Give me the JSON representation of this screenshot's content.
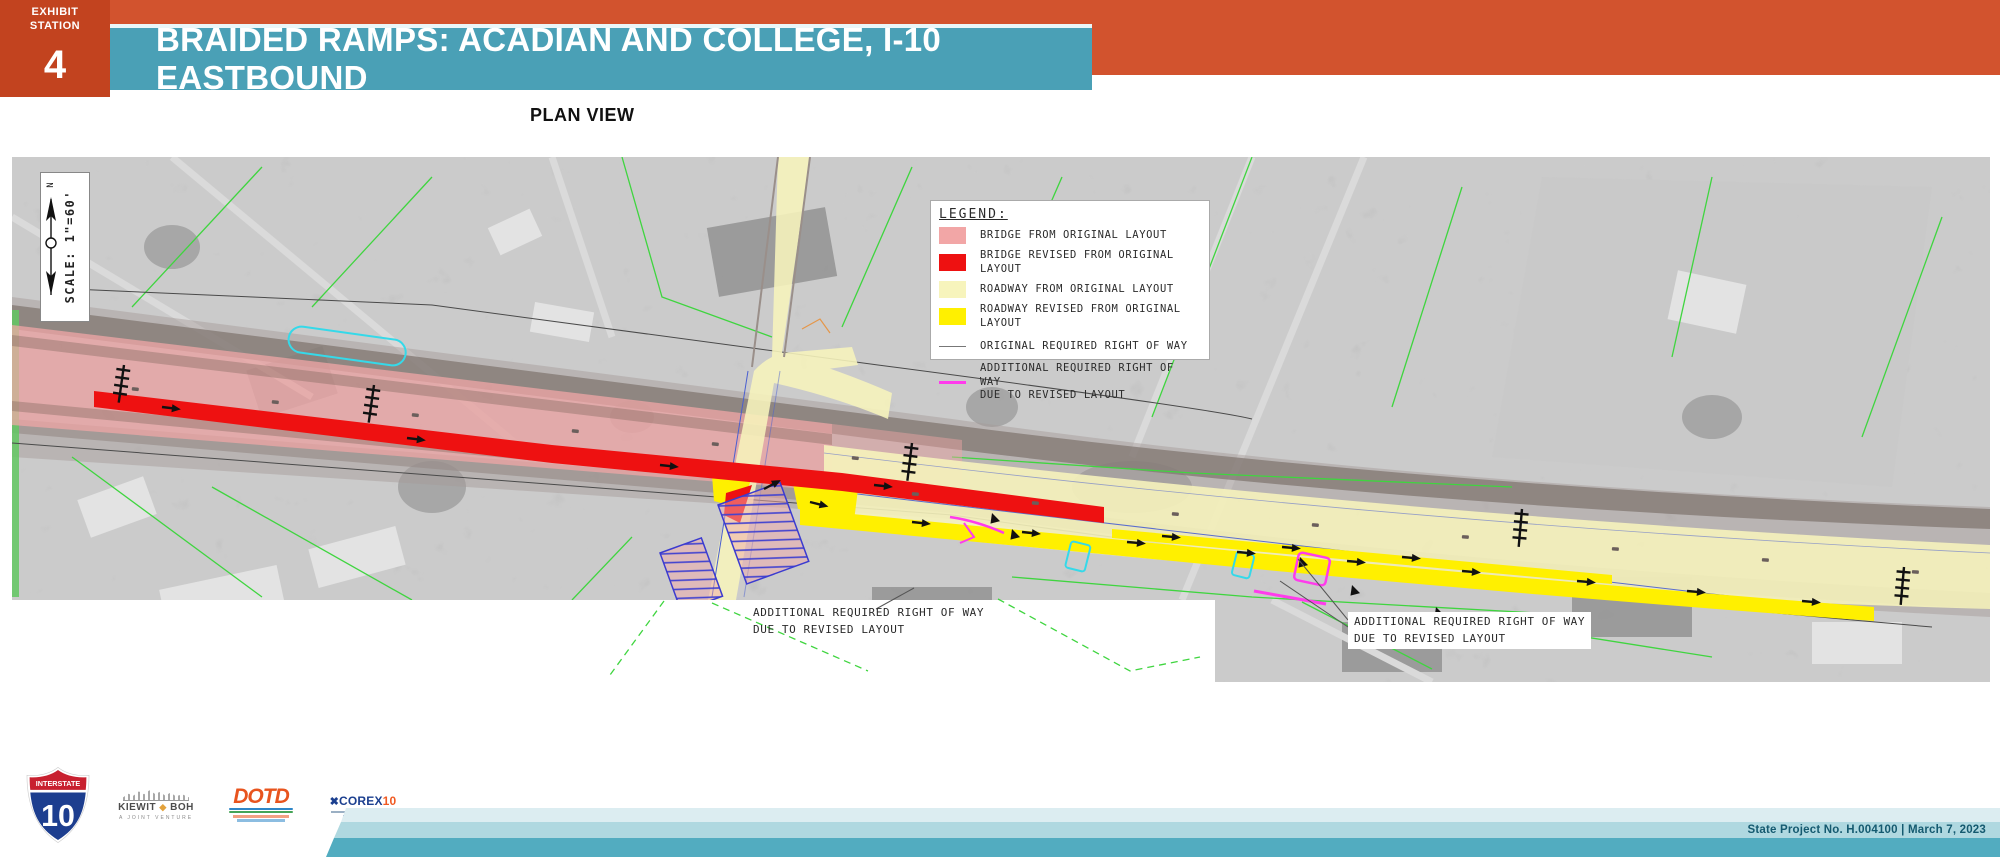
{
  "exhibit_tab": {
    "label": "EXHIBIT\nSTATION",
    "number": "4"
  },
  "banner": {
    "title": "BRAIDED RAMPS: ACADIAN AND COLLEGE, I-10 EASTBOUND"
  },
  "view_label": "PLAN VIEW",
  "map": {
    "scale": {
      "text": "SCALE: 1\"=60'",
      "north": "N"
    },
    "legend": {
      "title": "LEGEND:",
      "items": [
        {
          "label": "BRIDGE FROM ORIGINAL LAYOUT",
          "color": "#F2A6A6",
          "type": "fill"
        },
        {
          "label": "BRIDGE REVISED FROM ORIGINAL LAYOUT",
          "color": "#EE1111",
          "type": "fill"
        },
        {
          "label": "ROADWAY FROM ORIGINAL LAYOUT",
          "color": "#F7F4BC",
          "type": "fill"
        },
        {
          "label": "ROADWAY REVISED FROM ORIGINAL LAYOUT",
          "color": "#FFF000",
          "type": "fill"
        },
        {
          "label": "ORIGINAL REQUIRED RIGHT OF WAY",
          "color": "#777777",
          "type": "line"
        },
        {
          "label": "ADDITIONAL REQUIRED RIGHT OF WAY\nDUE TO REVISED LAYOUT",
          "color": "#FF3BEC",
          "type": "line"
        }
      ]
    },
    "annotations": [
      {
        "text": "ADDITIONAL REQUIRED RIGHT OF WAY\nDUE TO REVISED LAYOUT"
      },
      {
        "text": "ADDITIONAL REQUIRED RIGHT OF WAY\nDUE TO REVISED LAYOUT"
      }
    ]
  },
  "footer": {
    "shield": {
      "top": "INTERSTATE",
      "number": "10"
    },
    "kiewit_boh": {
      "name_left": "KIEWIT",
      "name_right": "BOH",
      "subtitle": "A JOINT VENTURE"
    },
    "dotd": {
      "name": "DOTD"
    },
    "corex": {
      "name": "COREX",
      "suffix": "10"
    },
    "project_info": "State Project No. H.004100   |   March 7, 2023"
  },
  "colors": {
    "header_orange": "#D2532E",
    "exhibit_box_orange": "#C2431F",
    "banner_teal": "#4AA0B6",
    "bridge_original_pink": "#F2A6A6",
    "bridge_revised_red": "#EE1111",
    "roadway_original_pale_yellow": "#F7F4BC",
    "roadway_revised_yellow": "#FFF000",
    "original_row_gray": "#777777",
    "additional_row_magenta": "#FF3BEC",
    "footer_stripe_dark_teal": "#52ACC0",
    "footer_stripe_light_teal": "#AFD8E0"
  }
}
